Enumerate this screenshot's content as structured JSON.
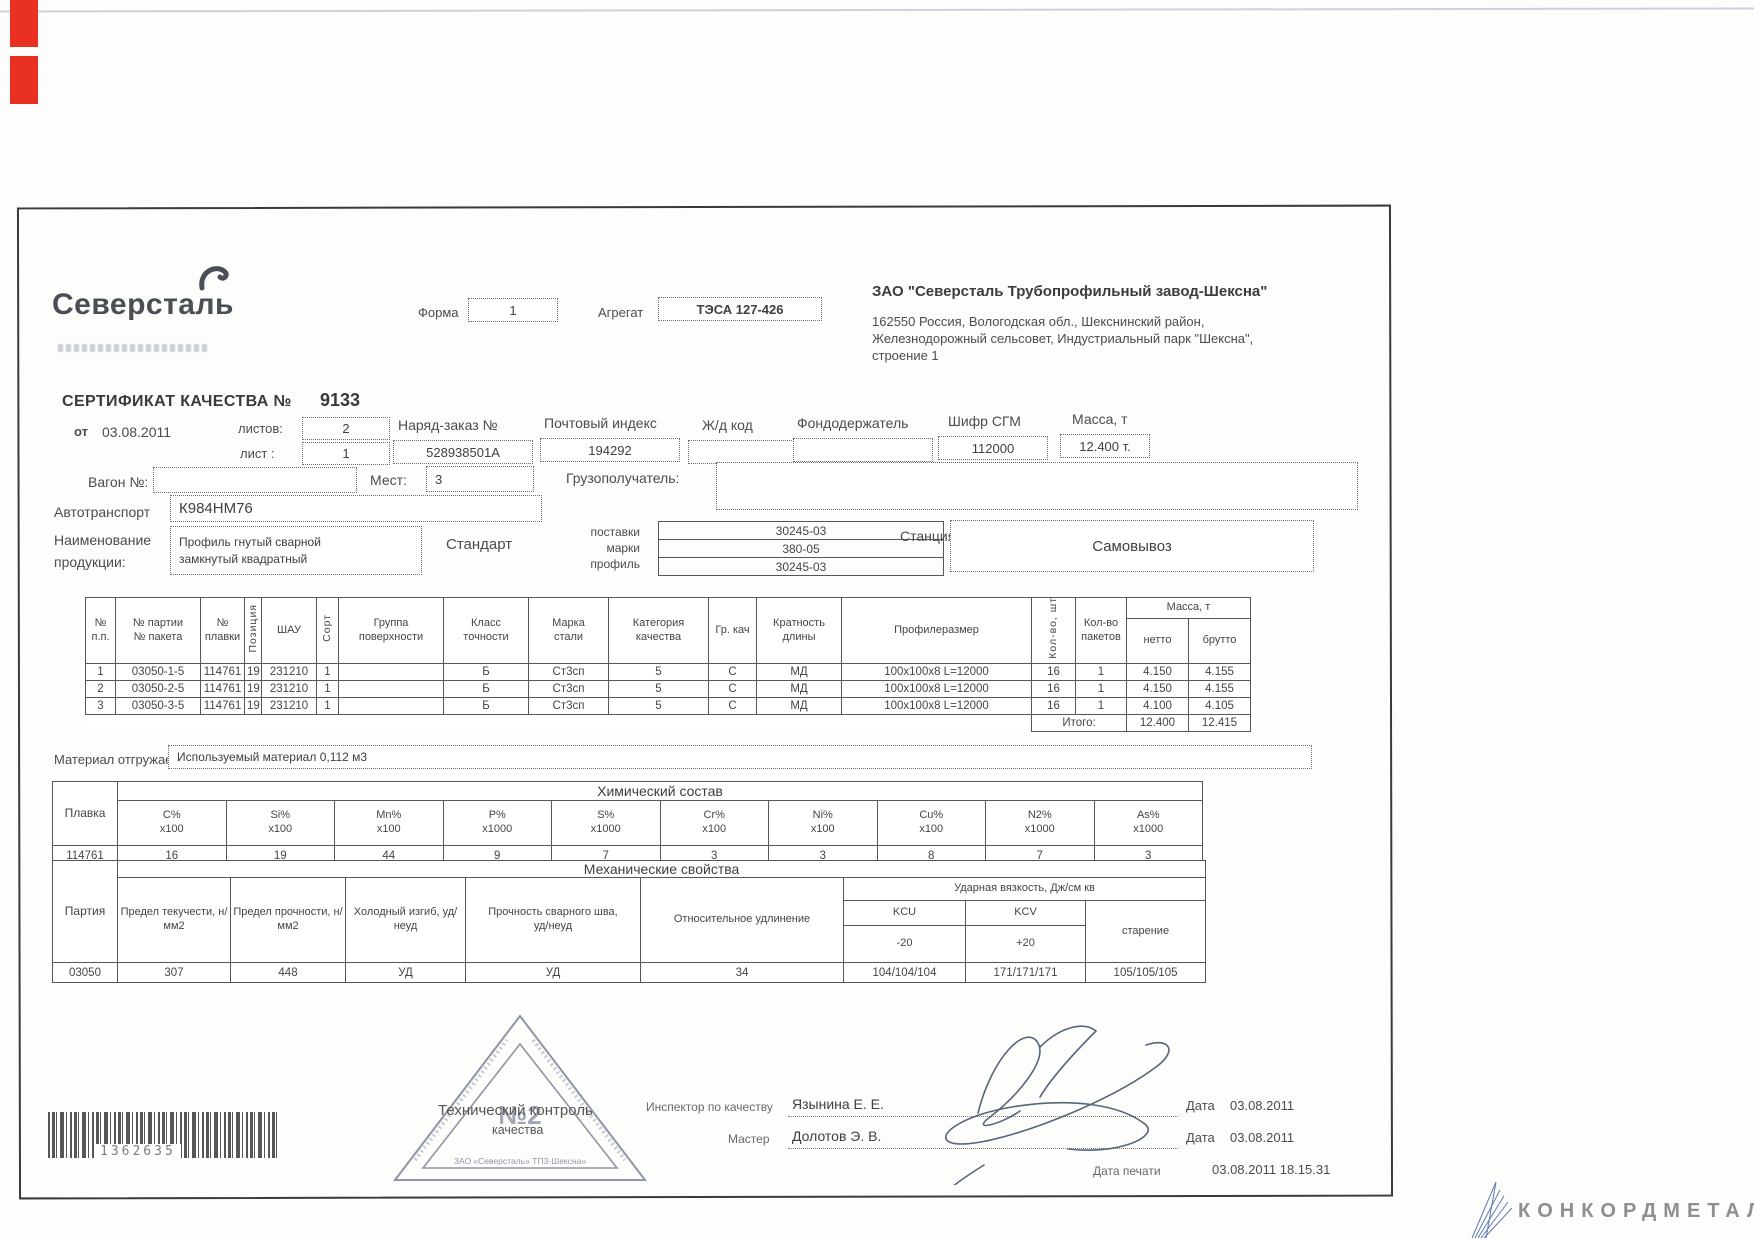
{
  "scan": {
    "barcode_number": "1362635",
    "watermark": "КОНКОРДМЕТАЛЛ"
  },
  "header": {
    "logo_text": "Северсталь",
    "forma_label": "Форма",
    "forma_value": "1",
    "agregat_label": "Агрегат",
    "agregat_value": "ТЭСА 127-426",
    "company_name": "ЗАО \"Северсталь Трубопрофильный завод-Шексна\"",
    "address_line1": "162550 Россия, Вологодская обл., Шекснинский район,",
    "address_line2": "Железнодорожный сельсовет, Индустриальный парк \"Шексна\",",
    "address_line3": "строение 1"
  },
  "cert": {
    "title": "СЕРТИФИКАТ КАЧЕСТВА №",
    "number": "9133",
    "date_prefix": "от",
    "date": "03.08.2011",
    "listov_label": "листов:",
    "listov_value": "2",
    "list_label": "лист :",
    "list_value": "1",
    "order_label": "Наряд-заказ №",
    "order_value": "528938501A",
    "postindex_label": "Почтовый индекс",
    "postindex_value": "194292",
    "zhd_label": "Ж/д код",
    "zhd_value": "",
    "fond_label": "Фондодержатель",
    "fond_value": "",
    "sgm_label": "Шифр СГМ",
    "sgm_value": "112000",
    "mass_label": "Масса, т",
    "mass_value": "12.400 т.",
    "wagon_label": "Вагон №:",
    "wagon_value": "",
    "mest_label": "Мест:",
    "mest_value": "3",
    "consignee_label": "Грузополучатель:",
    "consignee_value": "",
    "auto_label": "Автотранспорт",
    "auto_value": "К984НМ76",
    "product_label_line1": "Наименование",
    "product_label_line2": "продукции:",
    "product_line1": "Профиль гнутый сварной",
    "product_line2": "замкнутый квадратный",
    "standard_label": "Стандарт",
    "standard_row_labels": [
      "поставки",
      "марки",
      "профиль"
    ],
    "standard_values": [
      "30245-03",
      "380-05",
      "30245-03"
    ],
    "station_label": "Станция:",
    "station_value": "Самовывоз"
  },
  "main_table": {
    "mass_group_header": "Масса, т",
    "headers": [
      "№\nп.п.",
      "№ партии\n№ пакета",
      "№\nплавки",
      "Позиция",
      "ШАУ",
      "Сорт",
      "Группа\nповерхности",
      "Класс\nточности",
      "Марка\nстали",
      "Категория\nкачества",
      "Гр. кач",
      "Кратность\nдлины",
      "Профилеразмер",
      "Кол-во, шт",
      "Кол-во\nпакетов",
      "нетто",
      "брутто"
    ],
    "rows": [
      [
        "1",
        "03050-1-5",
        "114761",
        "19",
        "231210",
        "1",
        "",
        "Б",
        "Ст3сп",
        "5",
        "С",
        "МД",
        "100х100х8 L=12000",
        "16",
        "1",
        "4.150",
        "4.155"
      ],
      [
        "2",
        "03050-2-5",
        "114761",
        "19",
        "231210",
        "1",
        "",
        "Б",
        "Ст3сп",
        "5",
        "С",
        "МД",
        "100х100х8 L=12000",
        "16",
        "1",
        "4.150",
        "4.155"
      ],
      [
        "3",
        "03050-3-5",
        "114761",
        "19",
        "231210",
        "1",
        "",
        "Б",
        "Ст3сп",
        "5",
        "С",
        "МД",
        "100х100х8 L=12000",
        "16",
        "1",
        "4.100",
        "4.105"
      ]
    ],
    "total_label": "Итого:",
    "total_net": "12.400",
    "total_gross": "12.415"
  },
  "material": {
    "label": "Материал отгружаемый:",
    "value": "Используемый материал 0,112 м3"
  },
  "chemistry": {
    "title": "Химический состав",
    "melt_label": "Плавка",
    "melt_value": "114761",
    "elements": [
      "C%",
      "Si%",
      "Mn%",
      "P%",
      "S%",
      "Cr%",
      "Ni%",
      "Cu%",
      "N2%",
      "As%"
    ],
    "multipliers": [
      "х100",
      "х100",
      "х100",
      "х1000",
      "х1000",
      "х100",
      "х100",
      "х100",
      "х1000",
      "х1000"
    ],
    "values": [
      "16",
      "19",
      "44",
      "9",
      "7",
      "3",
      "3",
      "8",
      "7",
      "3"
    ]
  },
  "mechanics": {
    "title": "Механические свойства",
    "party_label": "Партия",
    "party_value": "03050",
    "col_yield": "Предел текучести, н/мм2",
    "col_tensile": "Предел прочности, н/мм2",
    "col_bend": "Холодный изгиб, уд/неуд",
    "col_weld": "Прочность сварного шва,\nуд/неуд",
    "col_elong": "Относительное удлинение",
    "impact_title": "Ударная вязкость, Дж/см кв",
    "kcu_label": "KCU",
    "kcu_temp": "-20",
    "kcv_label": "KCV",
    "kcv_temp": "+20",
    "aging_label": "старение",
    "val_yield": "307",
    "val_tensile": "448",
    "val_bend": "УД",
    "val_weld": "УД",
    "val_elong": "34",
    "val_kcu": "104/104/104",
    "val_kcv": "171/171/171",
    "val_aging": "105/105/105"
  },
  "stamp": {
    "number": "№2",
    "doc_text_line1": "Технический контроль",
    "doc_text_line2": "качества",
    "org_line": "ЗАО «Северсталь» ТПЗ-Шексна»"
  },
  "signatures": {
    "inspector_label": "Инспектор по качеству",
    "inspector_name": "Язынина Е. Е.",
    "master_label": "Мастер",
    "master_name": "Долотов Э. В.",
    "date_label1": "Дата",
    "date_value1": "03.08.2011",
    "date_label2": "Дата",
    "date_value2": "03.08.2011",
    "print_date_label": "Дата печати",
    "print_date_value": "03.08.2011 18.15.31"
  }
}
